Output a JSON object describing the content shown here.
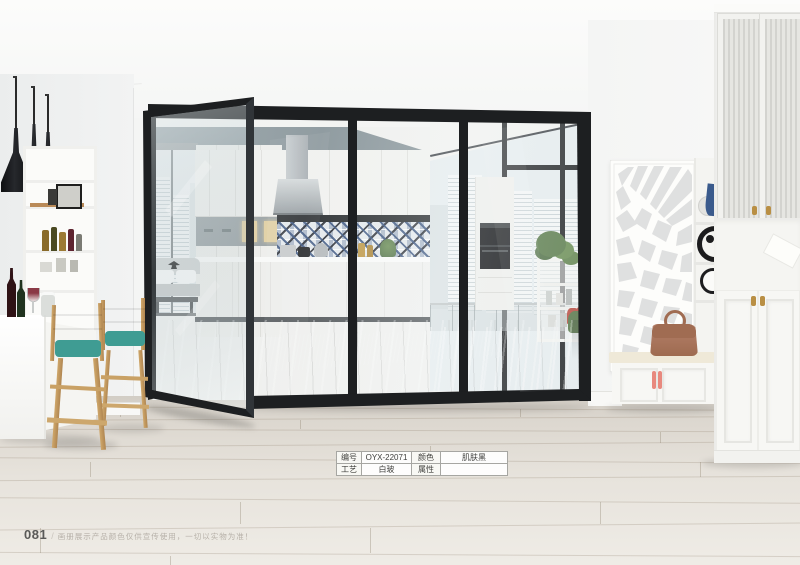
{
  "page": {
    "number": "081",
    "divider": "/",
    "disclaimer": "画册展示产品颜色仅供宣传使用，一切以实物为准！"
  },
  "spec_table": {
    "rows": [
      {
        "c1": "编号",
        "c2": "OYX-22071",
        "c3": "颜色",
        "c4": "肌肤黑"
      },
      {
        "c1": "工艺",
        "c2": "白玻",
        "c3": "属性",
        "c4": ""
      }
    ]
  },
  "colors": {
    "door_frame_black": "#1d1f21",
    "stool_teal": "#54b2a9",
    "rug_teal": "#769fa4",
    "wood_leg": "#c49e62",
    "interior_wall_blue_gray": "#8c989d",
    "wood_floor": "#ddd8d0",
    "bag_brown": "#ac7a5f",
    "bench_handle_coral": "#e8897e",
    "cabinet_knob_gold": "#b98f44"
  }
}
